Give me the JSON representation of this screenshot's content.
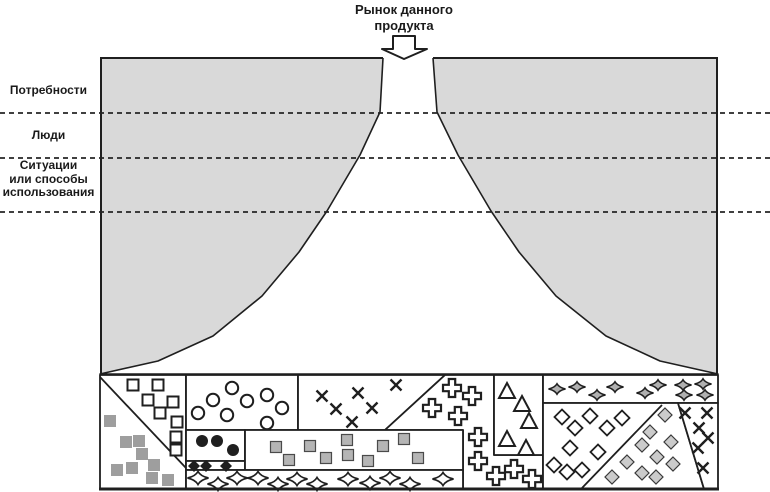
{
  "title": {
    "line1": "Рынок данного",
    "line2": "продукта"
  },
  "side_labels": [
    {
      "id": "needs",
      "lines": [
        "Потребности",
        "",
        ""
      ]
    },
    {
      "id": "people",
      "lines": [
        "Люди",
        "",
        ""
      ]
    },
    {
      "id": "situations",
      "lines": [
        "Ситуации",
        "или способы",
        "использования"
      ]
    }
  ],
  "dashed_line_ys": [
    113,
    158,
    212
  ],
  "colors": {
    "surround": "#d9d9d9",
    "line": "#1f1f1f",
    "gray_square": "#9e9e9e",
    "gray_mid": "#b5b5b5",
    "gray_light": "#cbcbcb",
    "star_gray": "#b0b0b0"
  },
  "frame": {
    "left": 100,
    "top": 58,
    "right": 718,
    "bottom": 489
  },
  "funnel": {
    "left": [
      [
        383,
        58
      ],
      [
        380,
        112
      ],
      [
        360,
        155
      ],
      [
        327,
        211
      ],
      [
        299,
        252
      ],
      [
        262,
        296
      ],
      [
        213,
        336
      ],
      [
        158,
        361
      ],
      [
        100,
        374
      ]
    ],
    "right": [
      [
        433,
        58
      ],
      [
        437,
        112
      ],
      [
        458,
        155
      ],
      [
        491,
        211
      ],
      [
        519,
        252
      ],
      [
        556,
        296
      ],
      [
        606,
        336
      ],
      [
        660,
        361
      ],
      [
        718,
        374
      ]
    ]
  },
  "arrow": {
    "points": [
      [
        393,
        36
      ],
      [
        415,
        36
      ],
      [
        415,
        49
      ],
      [
        427,
        49
      ],
      [
        404,
        59
      ],
      [
        382,
        49
      ],
      [
        393,
        49
      ]
    ]
  },
  "mosaic": {
    "top": 375,
    "bottom": 489,
    "cells": [
      {
        "name": "segment-squares",
        "pts": [
          [
            100,
            375
          ],
          [
            186,
            375
          ],
          [
            186,
            489
          ],
          [
            100,
            489
          ]
        ]
      },
      {
        "name": "segment-circles",
        "pts": [
          [
            186,
            375
          ],
          [
            298,
            375
          ],
          [
            298,
            430
          ],
          [
            186,
            430
          ]
        ]
      },
      {
        "name": "segment-x-marks",
        "pts": [
          [
            298,
            375
          ],
          [
            445,
            375
          ],
          [
            385,
            430
          ],
          [
            298,
            430
          ]
        ]
      },
      {
        "name": "segment-crosses",
        "pts": [
          [
            445,
            375
          ],
          [
            494,
            375
          ],
          [
            494,
            455
          ],
          [
            543,
            455
          ],
          [
            543,
            489
          ],
          [
            463,
            489
          ],
          [
            463,
            430
          ],
          [
            385,
            430
          ]
        ]
      },
      {
        "name": "segment-triangles",
        "pts": [
          [
            494,
            375
          ],
          [
            543,
            375
          ],
          [
            543,
            455
          ],
          [
            494,
            455
          ]
        ]
      },
      {
        "name": "segment-stars-top",
        "pts": [
          [
            543,
            375
          ],
          [
            718,
            375
          ],
          [
            718,
            403
          ],
          [
            543,
            403
          ]
        ]
      },
      {
        "name": "segment-diamonds",
        "pts": [
          [
            543,
            403
          ],
          [
            678,
            403
          ],
          [
            704,
            489
          ],
          [
            543,
            489
          ]
        ]
      },
      {
        "name": "segment-x-marks-right",
        "pts": [
          [
            678,
            403
          ],
          [
            718,
            403
          ],
          [
            718,
            489
          ],
          [
            704,
            489
          ]
        ]
      },
      {
        "name": "segment-black-dots",
        "pts": [
          [
            186,
            430
          ],
          [
            245,
            430
          ],
          [
            245,
            461
          ],
          [
            186,
            461
          ]
        ]
      },
      {
        "name": "segment-black-diamonds",
        "pts": [
          [
            186,
            461
          ],
          [
            245,
            461
          ],
          [
            245,
            470
          ],
          [
            186,
            470
          ]
        ]
      },
      {
        "name": "segment-gray-squares",
        "pts": [
          [
            245,
            430
          ],
          [
            463,
            430
          ],
          [
            463,
            470
          ],
          [
            245,
            470
          ]
        ]
      },
      {
        "name": "segment-stars-bottom",
        "pts": [
          [
            186,
            470
          ],
          [
            463,
            470
          ],
          [
            463,
            489
          ],
          [
            186,
            489
          ]
        ]
      }
    ],
    "inner_lines": [
      [
        100,
        377,
        186,
        468
      ],
      [
        662,
        405,
        582,
        488
      ]
    ],
    "symbol_groups": [
      {
        "type": "square_open",
        "points": [
          [
            133,
            385
          ],
          [
            158,
            385
          ],
          [
            148,
            400
          ],
          [
            173,
            402
          ],
          [
            160,
            413
          ],
          [
            177,
            422
          ],
          [
            176,
            437
          ],
          [
            176,
            450
          ]
        ]
      },
      {
        "type": "square_gray",
        "points": [
          [
            110,
            421
          ],
          [
            126,
            442
          ],
          [
            139,
            441
          ],
          [
            142,
            454
          ],
          [
            154,
            465
          ],
          [
            117,
            470
          ],
          [
            132,
            468
          ],
          [
            152,
            478
          ],
          [
            168,
            480
          ]
        ]
      },
      {
        "type": "circle_open",
        "points": [
          [
            232,
            388
          ],
          [
            267,
            395
          ],
          [
            213,
            400
          ],
          [
            247,
            401
          ],
          [
            282,
            408
          ],
          [
            198,
            413
          ],
          [
            227,
            415
          ],
          [
            267,
            423
          ]
        ]
      },
      {
        "type": "x_mark",
        "points": [
          [
            322,
            396
          ],
          [
            358,
            393
          ],
          [
            396,
            385
          ],
          [
            336,
            409
          ],
          [
            372,
            408
          ],
          [
            352,
            422
          ]
        ]
      },
      {
        "type": "cross",
        "points": [
          [
            452,
            388
          ],
          [
            472,
            396
          ],
          [
            432,
            408
          ],
          [
            458,
            416
          ],
          [
            478,
            437
          ],
          [
            478,
            461
          ],
          [
            496,
            476
          ],
          [
            514,
            469
          ],
          [
            532,
            479
          ]
        ]
      },
      {
        "type": "triangle",
        "points": [
          [
            507,
            391
          ],
          [
            522,
            404
          ],
          [
            529,
            421
          ],
          [
            507,
            439
          ],
          [
            526,
            448
          ]
        ]
      },
      {
        "type": "star_gray",
        "points": [
          [
            557,
            389
          ],
          [
            577,
            387
          ],
          [
            597,
            395
          ],
          [
            615,
            387
          ],
          [
            645,
            393
          ],
          [
            658,
            385
          ],
          [
            683,
            385
          ],
          [
            684,
            395
          ],
          [
            703,
            384
          ],
          [
            705,
            395
          ]
        ]
      },
      {
        "type": "diamond_open",
        "points": [
          [
            562,
            417
          ],
          [
            590,
            416
          ],
          [
            622,
            418
          ],
          [
            575,
            428
          ],
          [
            607,
            428
          ],
          [
            570,
            448
          ],
          [
            598,
            452
          ],
          [
            554,
            465
          ],
          [
            567,
            472
          ],
          [
            582,
            470
          ]
        ]
      },
      {
        "type": "diamond_gray",
        "points": [
          [
            665,
            415
          ],
          [
            650,
            432
          ],
          [
            671,
            442
          ],
          [
            642,
            445
          ],
          [
            657,
            457
          ],
          [
            673,
            464
          ],
          [
            627,
            462
          ],
          [
            642,
            473
          ],
          [
            656,
            477
          ],
          [
            612,
            477
          ]
        ]
      },
      {
        "type": "x_mark",
        "points": [
          [
            685,
            413
          ],
          [
            707,
            413
          ],
          [
            699,
            428
          ],
          [
            708,
            438
          ],
          [
            698,
            448
          ],
          [
            703,
            468
          ]
        ]
      },
      {
        "type": "circle_black",
        "points": [
          [
            202,
            441
          ],
          [
            217,
            441
          ],
          [
            233,
            450
          ]
        ]
      },
      {
        "type": "diamond_black",
        "points": [
          [
            194,
            466
          ],
          [
            206,
            466
          ],
          [
            226,
            466
          ]
        ]
      },
      {
        "type": "square_mid",
        "points": [
          [
            276,
            447
          ],
          [
            310,
            446
          ],
          [
            347,
            440
          ],
          [
            348,
            455
          ],
          [
            383,
            446
          ],
          [
            404,
            439
          ],
          [
            289,
            460
          ],
          [
            326,
            458
          ],
          [
            368,
            461
          ],
          [
            418,
            458
          ]
        ]
      },
      {
        "type": "star_open",
        "points": [
          [
            198,
            478
          ],
          [
            218,
            484
          ],
          [
            237,
            478
          ],
          [
            258,
            478
          ],
          [
            278,
            484
          ],
          [
            297,
            479
          ],
          [
            317,
            484
          ],
          [
            348,
            479
          ],
          [
            370,
            483
          ],
          [
            390,
            478
          ],
          [
            410,
            484
          ],
          [
            443,
            479
          ]
        ]
      }
    ]
  }
}
